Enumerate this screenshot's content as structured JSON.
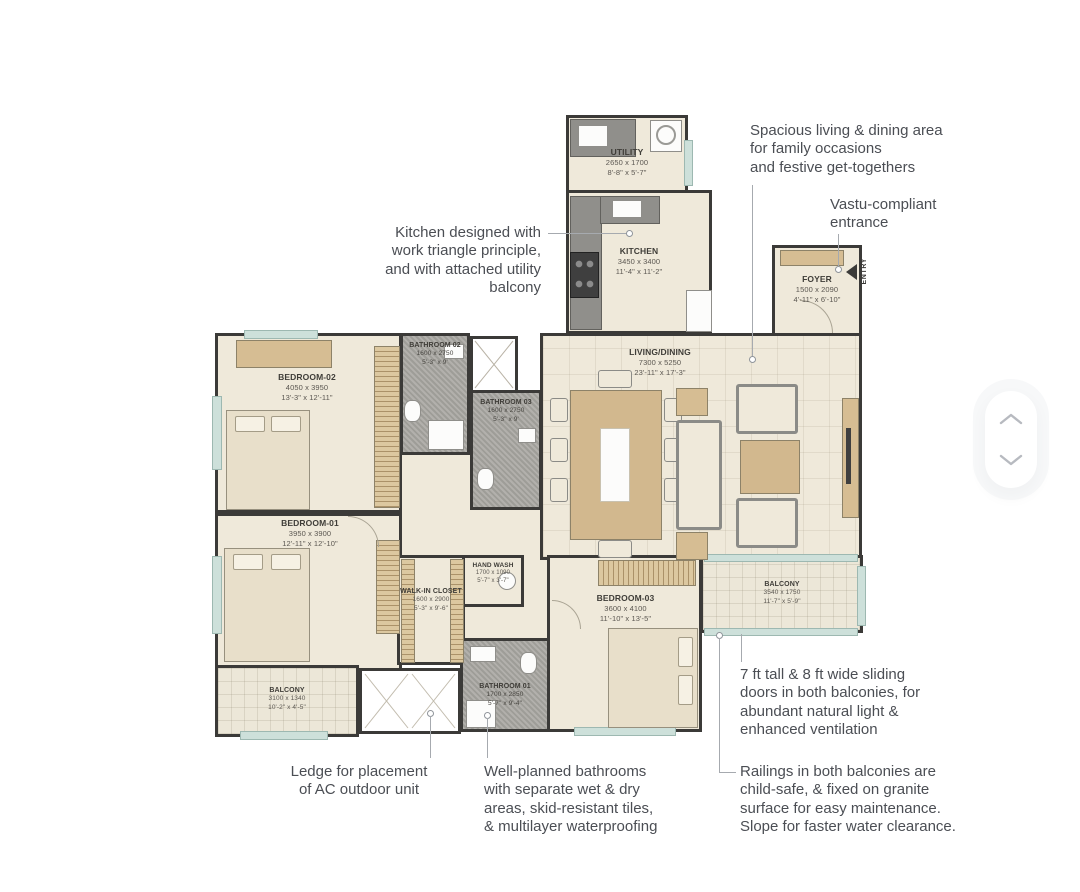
{
  "colors": {
    "wall": "#3b3a38",
    "floor": "#efe9da",
    "bathroom_floor": "#a7a5a0",
    "wood": "#d6bd93",
    "window_glass": "#cde0da",
    "annotation_text": "#4b4e54",
    "background": "#ffffff"
  },
  "entry": {
    "label": "ENTRY"
  },
  "rooms": {
    "utility": {
      "name": "UTILITY",
      "mm": "2650 x 1700",
      "ft": "8'-8\" x 5'-7\""
    },
    "kitchen": {
      "name": "KITCHEN",
      "mm": "3450 x 3400",
      "ft": "11'-4\" x 11'-2\""
    },
    "foyer": {
      "name": "FOYER",
      "mm": "1500 x 2090",
      "ft": "4'-11\" x 6'-10\""
    },
    "living": {
      "name": "LIVING/DINING",
      "mm": "7300 x 5250",
      "ft": "23'-11\" x 17'-3\""
    },
    "bedroom2": {
      "name": "BEDROOM-02",
      "mm": "4050 x 3950",
      "ft": "13'-3\" x 12'-11\""
    },
    "bathroom2": {
      "name": "BATHROOM 02",
      "mm": "1600 x 2750",
      "ft": "5'-3\" x 9'"
    },
    "bathroom3": {
      "name": "BATHROOM 03",
      "mm": "1600 x 2750",
      "ft": "5'-3\" x 9'"
    },
    "bedroom1": {
      "name": "BEDROOM-01",
      "mm": "3950 x 3900",
      "ft": "12'-11\" x 12'-10\""
    },
    "walkin": {
      "name": "WALK-IN CLOSET",
      "mm": "1600 x 2900",
      "ft": "5'-3\" x 9'-6\""
    },
    "handwash": {
      "name": "HAND WASH",
      "mm": "1700 x 1090",
      "ft": "5'-7\" x 3'-7\""
    },
    "bathroom1": {
      "name": "BATHROOM 01",
      "mm": "1700 x 2850",
      "ft": "5'-7\" x 9'-4\""
    },
    "bedroom3": {
      "name": "BEDROOM-03",
      "mm": "3600 x 4100",
      "ft": "11'-10\" x 13'-5\""
    },
    "balcony_right": {
      "name": "BALCONY",
      "mm": "3540 x 1750",
      "ft": "11'-7\" x 5'-9\""
    },
    "balcony_left": {
      "name": "BALCONY",
      "mm": "3100 x 1340",
      "ft": "10'-2\" x 4'-5\""
    }
  },
  "annotations": {
    "living": "Spacious living & dining area\nfor family occasions\nand festive get-togethers",
    "entrance": "Vastu-compliant\nentrance",
    "kitchen": "Kitchen designed with\nwork triangle principle,\nand with attached utility\nbalcony",
    "sliding_doors": "7 ft tall & 8 ft wide sliding\ndoors in both balconies, for\nabundant natural light &\nenhanced ventilation",
    "railings": "Railings in both balconies are\nchild-safe, & fixed on granite\nsurface for easy maintenance.\nSlope for faster water clearance.",
    "ledge": "Ledge for placement\nof AC outdoor unit",
    "bathrooms": "Well-planned bathrooms\nwith separate wet & dry\nareas, skid-resistant tiles,\n& multilayer waterproofing"
  }
}
